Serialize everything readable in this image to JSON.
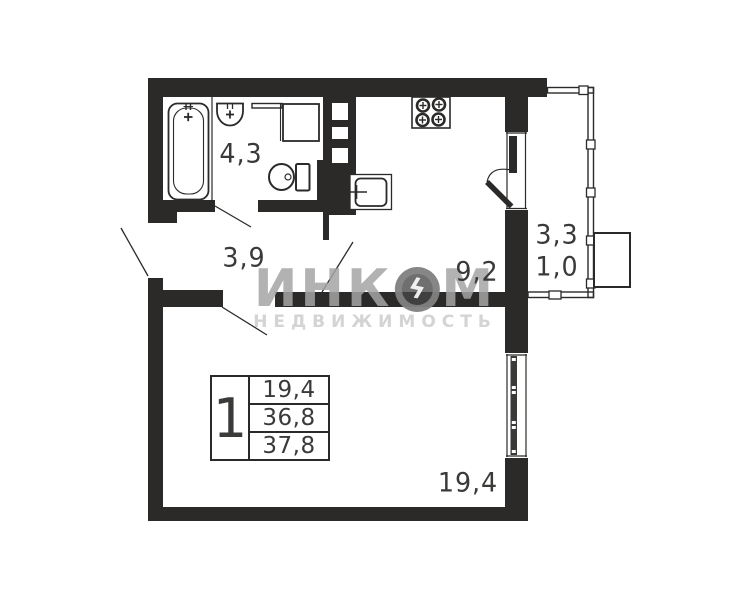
{
  "plan": {
    "labels": {
      "bathroom": "4,3",
      "hallway": "3,9",
      "kitchen": "9,2",
      "balcony_full": "3,3",
      "balcony_reduced": "1,0",
      "living_room": "19,4"
    },
    "table": {
      "rooms": "1",
      "rows": [
        "19,4",
        "36,8",
        "37,8"
      ]
    },
    "watermark": {
      "brand_part1": "ИНК",
      "brand_part2": "М",
      "bolt": "ϟ",
      "subtitle": "НЕДВИЖИМОСТЬ"
    },
    "colors": {
      "wall": "#2b2a29",
      "background": "#ffffff",
      "watermark_gray": "#a5a5a5"
    }
  }
}
